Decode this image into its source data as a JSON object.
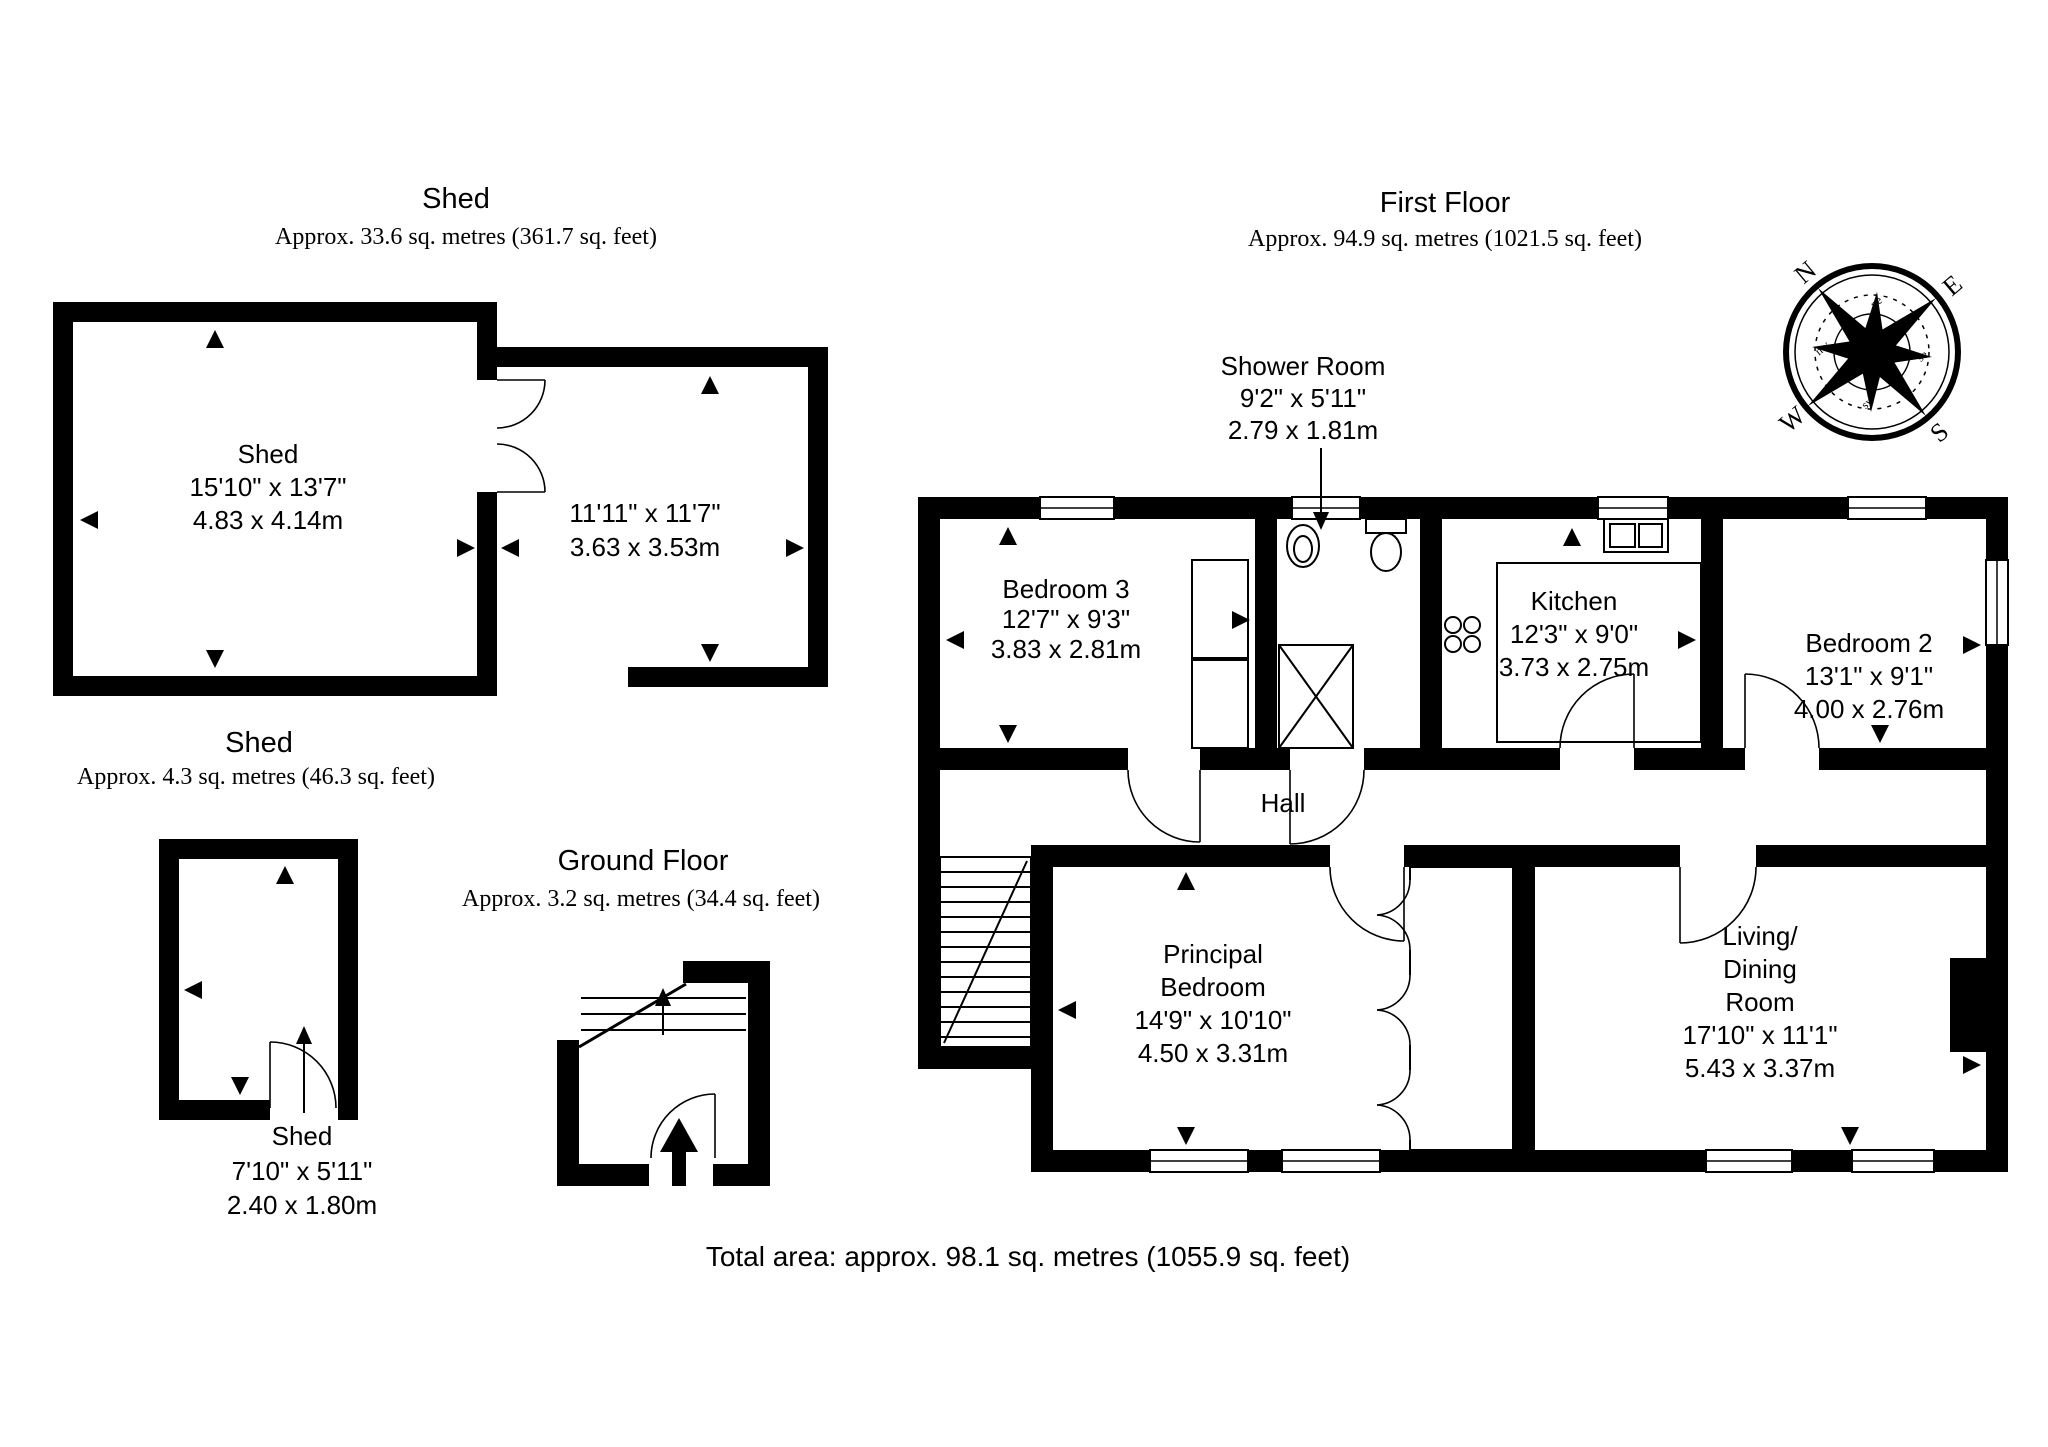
{
  "page": {
    "background": "#ffffff",
    "wall_color": "#000000"
  },
  "total_area": "Total area: approx. 98.1 sq. metres (1055.9 sq. feet)",
  "sections": {
    "shed_top": {
      "title": "Shed",
      "subtitle": "Approx. 33.6 sq. metres (361.7 sq. feet)"
    },
    "first_floor": {
      "title": "First Floor",
      "subtitle": "Approx. 94.9 sq. metres (1021.5 sq. feet)"
    },
    "shed_small": {
      "title": "Shed",
      "subtitle": "Approx. 4.3 sq. metres (46.3 sq. feet)"
    },
    "ground_floor": {
      "title": "Ground Floor",
      "subtitle": "Approx. 3.2 sq. metres (34.4 sq. feet)"
    }
  },
  "rooms": {
    "shed_main": {
      "name": "Shed",
      "imperial": "15'10\" x 13'7\"",
      "metric": "4.83 x 4.14m"
    },
    "shed_second": {
      "imperial": "11'11\" x 11'7\"",
      "metric": "3.63 x 3.53m"
    },
    "bedroom3": {
      "name": "Bedroom 3",
      "imperial": "12'7\" x 9'3\"",
      "metric": "3.83 x 2.81m"
    },
    "shower_room": {
      "name": "Shower Room",
      "imperial": "9'2\" x 5'11\"",
      "metric": "2.79 x 1.81m"
    },
    "kitchen": {
      "name": "Kitchen",
      "imperial": "12'3\" x 9'0\"",
      "metric": "3.73 x 2.75m"
    },
    "bedroom2": {
      "name": "Bedroom 2",
      "imperial": "13'1\" x 9'1\"",
      "metric": "4.00 x 2.76m"
    },
    "hall": {
      "name": "Hall"
    },
    "principal_bedroom": {
      "line1": "Principal",
      "line2": "Bedroom",
      "imperial": "14'9\" x 10'10\"",
      "metric": "4.50 x 3.31m"
    },
    "living_dining": {
      "line1": "Living/",
      "line2": "Dining",
      "line3": "Room",
      "imperial": "17'10\" x 11'1\"",
      "metric": "5.43 x 3.37m"
    },
    "shed_small_room": {
      "name": "Shed",
      "imperial": "7'10\" x 5'11\"",
      "metric": "2.40 x 1.80m"
    }
  },
  "compass": {
    "n": "N",
    "e": "E",
    "s": "S",
    "w": "W",
    "ne": "ne",
    "se": "se",
    "sw": "sw",
    "nw": "nw"
  }
}
